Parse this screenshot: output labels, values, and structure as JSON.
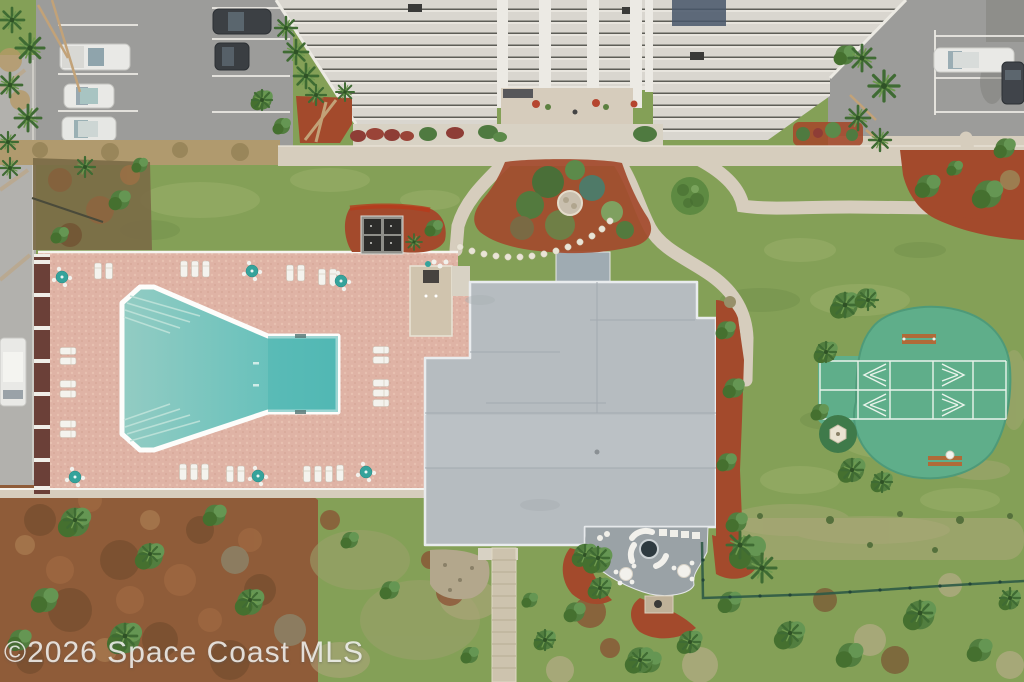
{
  "watermark": {
    "text": "©2026 Space Coast MLS"
  },
  "scene": {
    "type": "aerial-drone-photo",
    "features": [
      "condominium-building",
      "parking-lot-left",
      "parking-lot-right",
      "entrance-courtyard-garden",
      "swimming-pool",
      "pool-deck",
      "pool-cabana",
      "bbq-grill-area",
      "clubhouse-roof",
      "firepit-patio",
      "boardwalk",
      "shuffleboard-courts",
      "gazebo",
      "lawn",
      "beach-scrub",
      "palm-trees",
      "perimeter-fence"
    ]
  },
  "colors": {
    "grass": "#84a057",
    "grass_dry": "#a9a878",
    "asphalt": "#9c9c9a",
    "road": "#b2b1ad",
    "concrete": "#d6cdbd",
    "plaza": "#d6ccbc",
    "gravel": "#d8d2c4",
    "deck": "#dfb3a5",
    "wall": "#6b4038",
    "pool_shallow": "#8ac8c0",
    "pool_deep": "#54b9b5",
    "roof": "#b6bcc0",
    "roof_seam": "#a3aab0",
    "patio": "#9aa2a6",
    "mulch": "#a34a2c",
    "court": "#5fae8a",
    "court_line": "#eaf4ec",
    "palm_dark": "#3f6b33",
    "bush": "#527e3f",
    "scrub": "#8f5c39",
    "bench": "#b06a38",
    "fence": "#2f5a46",
    "stripe_bg": "#d9d6cf",
    "stripe_dark": "#5d5d57",
    "car_white": "#e9e9e6",
    "car_dark": "#3c4044",
    "umbrella": "#35a39b"
  }
}
